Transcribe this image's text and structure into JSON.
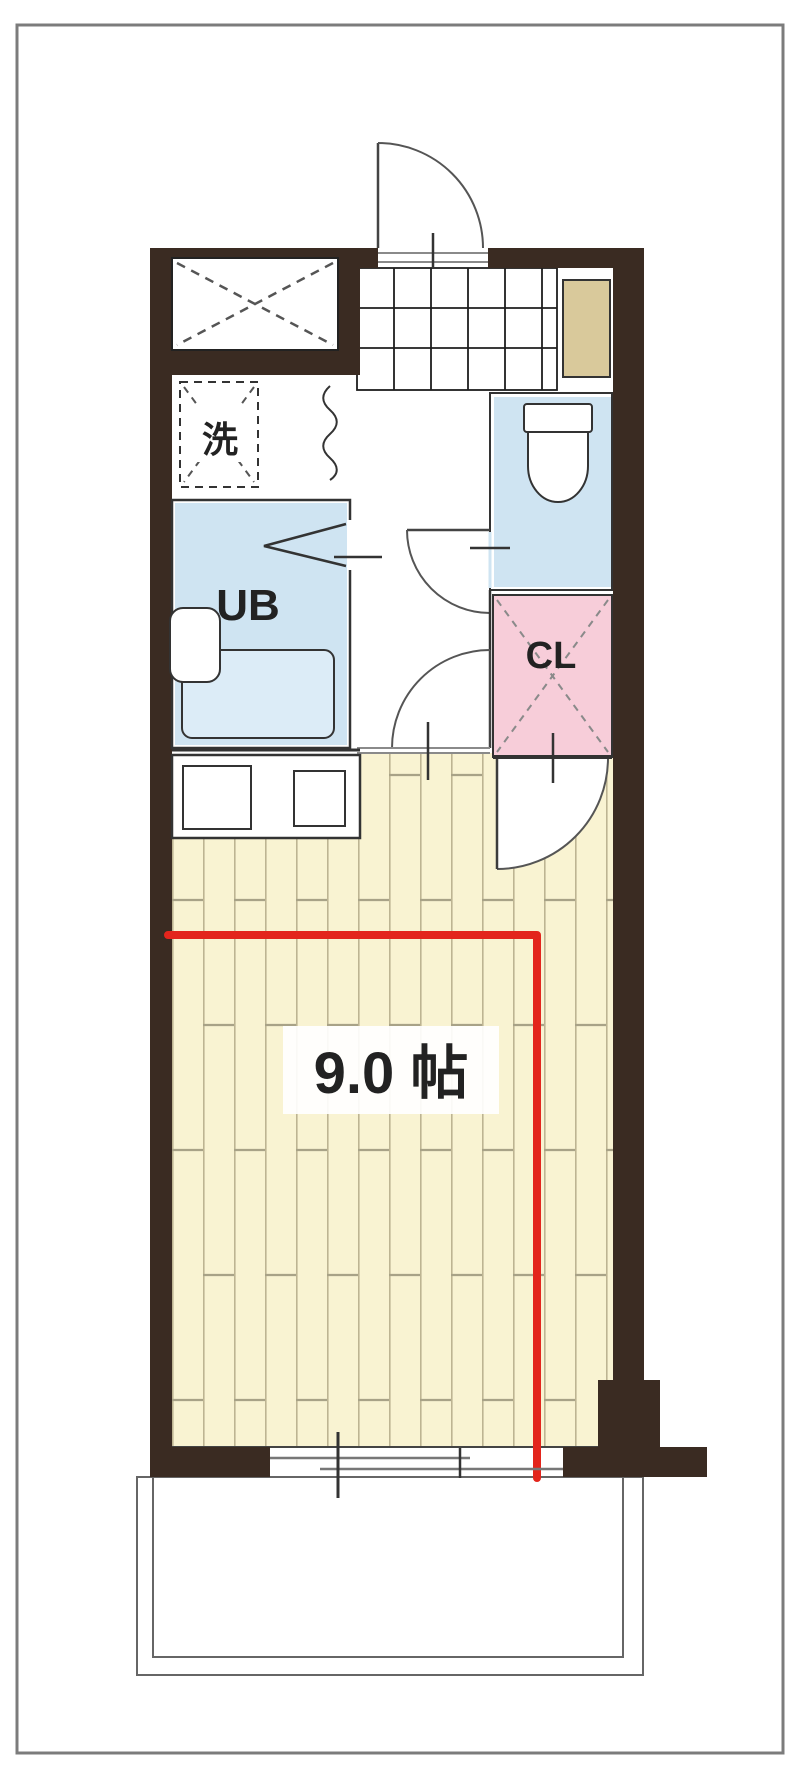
{
  "floor_plan": {
    "labels": {
      "laundry": "洗",
      "unit_bath": "UB",
      "closet": "CL",
      "main_room_size": "9.0 帖"
    },
    "colors": {
      "wall": "#3a2b22",
      "water_room": "#cfe4f2",
      "closet": "#f7cdd9",
      "flooring": "#f9f3d2",
      "flooring_line": "#bdb492",
      "cabinet": "#d9c99b",
      "highlight": "#e3251c",
      "line": "#3c3c3c",
      "frame": "#7c7c7c"
    }
  }
}
